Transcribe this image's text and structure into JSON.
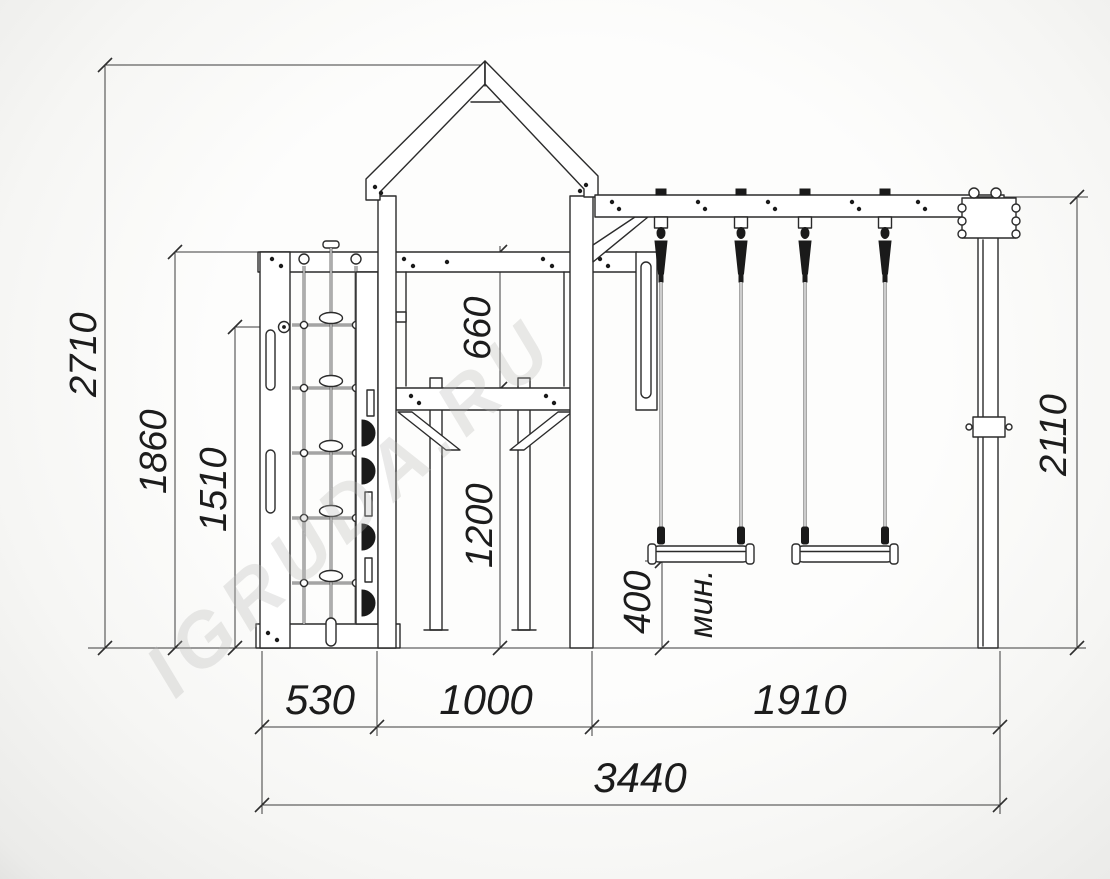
{
  "watermark": "IGRUDA.RU",
  "dims": {
    "overall_height": "2710",
    "frame_top_height": "1860",
    "handle_height": "1510",
    "rail_to_platform": "660",
    "platform_to_ground": "1200",
    "seat_clearance": "400",
    "seat_clearance_note": "мин.",
    "beam_height_right": "2110",
    "width_climb_module": "530",
    "width_tower": "1000",
    "width_swing_bay": "1910",
    "width_total": "3440"
  }
}
